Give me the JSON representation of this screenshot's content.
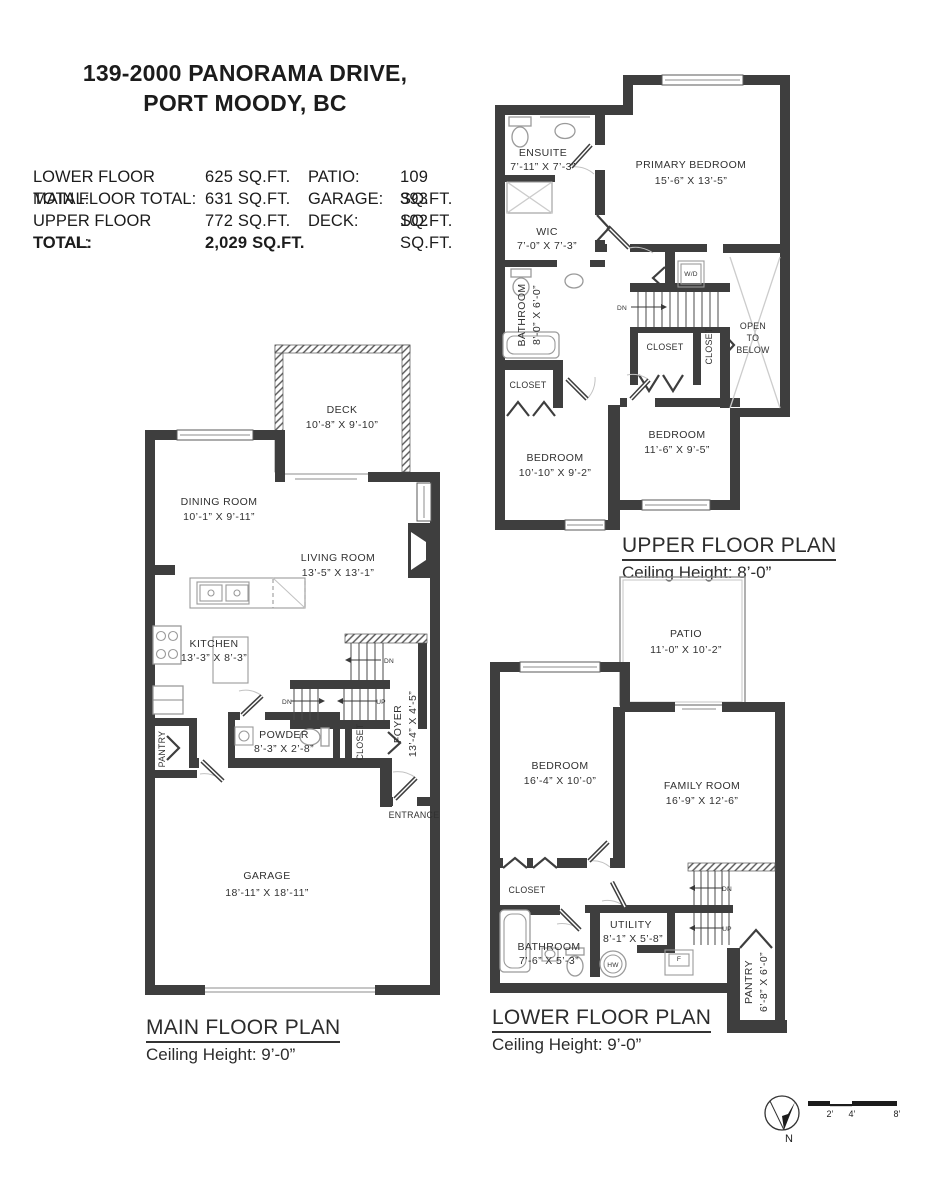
{
  "title": {
    "line1": "139-2000 PANORAMA DRIVE,",
    "line2": "PORT MOODY, BC"
  },
  "colors": {
    "wall": "#3e3e3e",
    "text": "#333333",
    "fixture": "#9a9a9a"
  },
  "stats": {
    "rows": [
      {
        "l1": "LOWER FLOOR TOTAL:",
        "v1": "625 SQ.FT.",
        "l2": "PATIO:",
        "v2": "109 SQ.FT."
      },
      {
        "l1": "MAIN FLOOR TOTAL:",
        "v1": "631 SQ.FT.",
        "l2": "GARAGE:",
        "v2": "393 SQ.FT."
      },
      {
        "l1": "UPPER FLOOR TOTAL:",
        "v1": "772 SQ.FT.",
        "l2": "DECK:",
        "v2": "102 SQ.FT."
      }
    ],
    "total_label": "TOTAL:",
    "total_value": "2,029 SQ.FT."
  },
  "upper": {
    "title": "UPPER FLOOR PLAN",
    "ceiling": "Ceiling Height: 8’-0”",
    "primary_name": "PRIMARY BEDROOM",
    "primary_dims": "15’-6” X 13’-5”",
    "ensuite_name": "ENSUITE",
    "ensuite_dims": "7’-11” X 7’-3”",
    "wic_name": "WIC",
    "wic_dims": "7’-0” X 7’-3”",
    "bath_name": "BATHROOM",
    "bath_dims": "8’-0” X 6’-0”",
    "bed1_name": "BEDROOM",
    "bed1_dims": "10’-10” X 9’-2”",
    "bed2_name": "BEDROOM",
    "bed2_dims": "11’-6” X 9’-5”",
    "closet": "CLOSET",
    "wd": "W/D",
    "open1": "OPEN",
    "open2": "TO",
    "open3": "BELOW",
    "dn": "DN"
  },
  "main": {
    "title": "MAIN FLOOR PLAN",
    "ceiling": "Ceiling Height: 9’-0”",
    "deck_name": "DECK",
    "deck_dims": "10’-8” X 9’-10”",
    "dining_name": "DINING ROOM",
    "dining_dims": "10’-1” X 9’-11”",
    "living_name": "LIVING ROOM",
    "living_dims": "13’-5” X 13’-1”",
    "kitchen_name": "KITCHEN",
    "kitchen_dims": "13’-3” X 8’-3”",
    "powder_name": "POWDER",
    "powder_dims": "8’-3” X 2’-8”",
    "foyer_name": "FOYER",
    "foyer_dims": "13’-4” X 4’-5”",
    "garage_name": "GARAGE",
    "garage_dims": "18’-11” X 18’-11”",
    "pantry": "PANTRY",
    "closet": "CLOSET",
    "entrance": "ENTRANCE",
    "dn": "DN",
    "up": "UP"
  },
  "lower": {
    "title": "LOWER FLOOR PLAN",
    "ceiling": "Ceiling Height: 9’-0”",
    "patio_name": "PATIO",
    "patio_dims": "11’-0” X 10’-2”",
    "bedroom_name": "BEDROOM",
    "bedroom_dims": "16’-4” X 10’-0”",
    "family_name": "FAMILY ROOM",
    "family_dims": "16’-9” X 12’-6”",
    "bath_name": "BATHROOM",
    "bath_dims": "7’-6” X 5’-3”",
    "utility_name": "UTILITY",
    "utility_dims": "8’-1” X 5’-8”",
    "pantry_name": "PANTRY",
    "pantry_dims": "6’-8” X 6’-0”",
    "closet": "CLOSET",
    "hw": "HW",
    "f": "F",
    "dn": "DN",
    "up": "UP"
  },
  "footer": {
    "north": "N",
    "scale": [
      "2’",
      "4’",
      "8’"
    ]
  }
}
